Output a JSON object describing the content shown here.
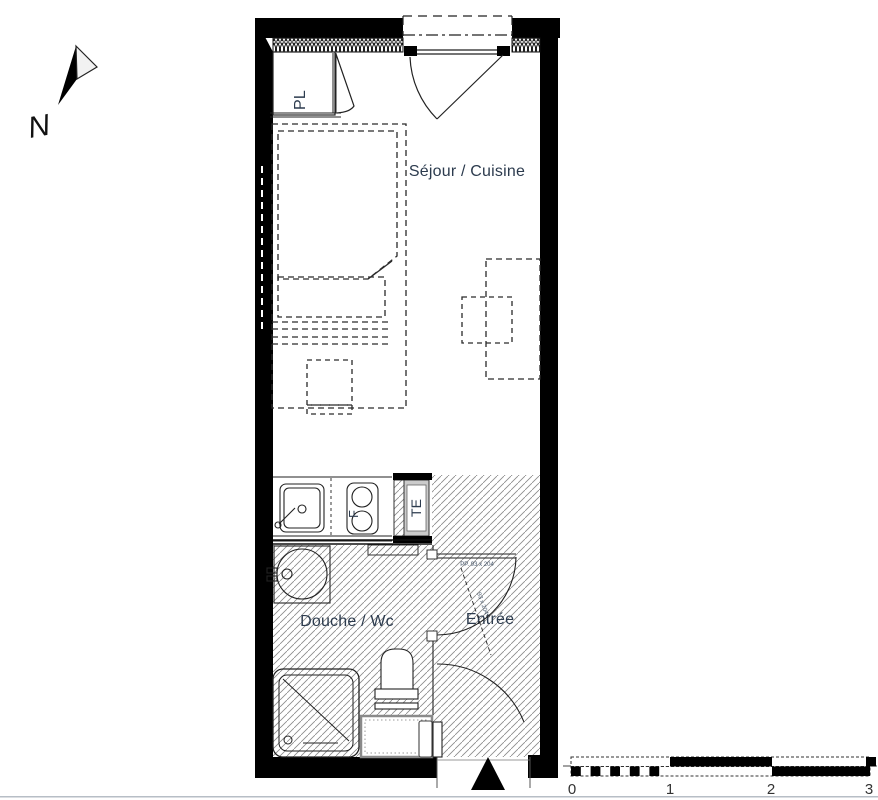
{
  "plan": {
    "compass": {
      "north_label": "N"
    },
    "rooms": {
      "closet_label": "PL",
      "living_kitchen_label": "Séjour / Cuisine",
      "electrical_panel_label": "TE",
      "bathroom_label": "Douche / Wc",
      "entrance_label": "Entrée"
    },
    "fixtures": {
      "stove_label": "F"
    },
    "doors": {
      "bathroom_door_label": "PP. 93 x 204",
      "entry_door_label": "93 x 204"
    },
    "scale_bar": {
      "ticks": [
        "0",
        "1",
        "2",
        "3"
      ]
    },
    "colors": {
      "wall": "#000000",
      "line": "#222222",
      "hatch": "#8a8a8a",
      "panel_gray": "#cbcbcb",
      "label_text": "#2c3b4e"
    }
  }
}
